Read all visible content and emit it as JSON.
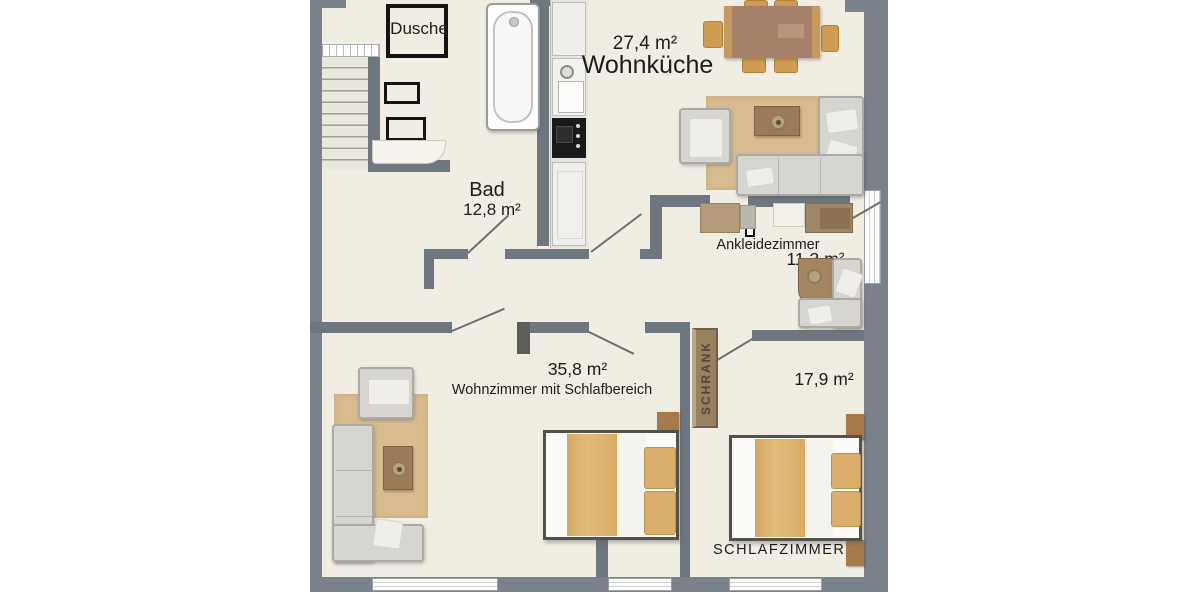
{
  "floorplan": {
    "rooms": {
      "dusche": {
        "name": "Dusche"
      },
      "bad": {
        "name": "Bad",
        "area": "12,8 m²"
      },
      "wohnkueche": {
        "name": "Wohnküche",
        "area": "27,4 m²"
      },
      "ankleidezimmer": {
        "name": "Ankleidezimmer",
        "area": "11,3 m²"
      },
      "wohnzimmer": {
        "name": "Wohnzimmer mit Schlafbereich",
        "area": "35,8 m²"
      },
      "schrank": {
        "name": "SCHRANK"
      },
      "schlafzimmer": {
        "name": "SCHLAFZIMMER",
        "area": "17,9 m²"
      }
    },
    "colors": {
      "wall": "#79818a",
      "floor": "#f0ede3",
      "rug": "#d8bb8e",
      "wood": "#9c7a58",
      "bedding": "#dcb26e",
      "dining_chair": "#cf9d51",
      "sofa": "#d6d5d0",
      "wardrobe": "#97815f"
    }
  }
}
